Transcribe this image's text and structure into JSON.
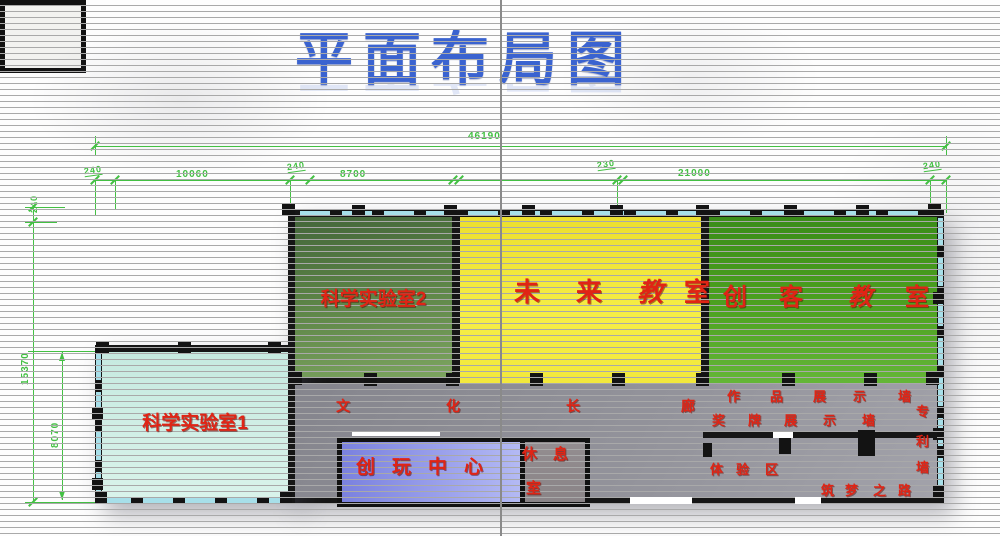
{
  "title": "平面布局图",
  "dims": {
    "total_w": "46190",
    "seg": [
      "240",
      "10060",
      "240",
      "8700",
      "230",
      "21000",
      "240"
    ],
    "total_h": "15370",
    "top_gap": "240",
    "annex_h": "8070"
  },
  "rooms": {
    "lab2": "科学实验室2",
    "future_chars": [
      "未",
      "来",
      "教",
      "室"
    ],
    "maker_chars": [
      "创",
      "客",
      "教",
      "室"
    ],
    "lab1": "科学实验室1",
    "play": "创玩中心",
    "rest_line1": "休息",
    "rest_line2": "室"
  },
  "corridor": {
    "hall": [
      "文",
      "化",
      "长",
      "廊"
    ],
    "works_wall": [
      "作",
      "品",
      "展",
      "示",
      "墙"
    ],
    "medal_wall": [
      "奖",
      "牌",
      "展",
      "示",
      "墙"
    ],
    "patent_wall": [
      "专",
      "利",
      "墙"
    ],
    "experience": [
      "体",
      "验",
      "区"
    ],
    "dream_road": [
      "筑",
      "梦",
      "之",
      "路"
    ]
  },
  "colors": {
    "title_blue": "#3a63d0",
    "dim_green": "#43c043",
    "label_red": "#e02415",
    "window_cyan": "#a7dfe9",
    "wall_black": "#161616",
    "corridor_gray": "#93939b",
    "lab2_green": "#5a8245",
    "future_yellow": "#f2e83c",
    "maker_green": "#4ba01f",
    "lab1_cyan": "#cdeee4",
    "play_blue": "#8a90e6"
  }
}
